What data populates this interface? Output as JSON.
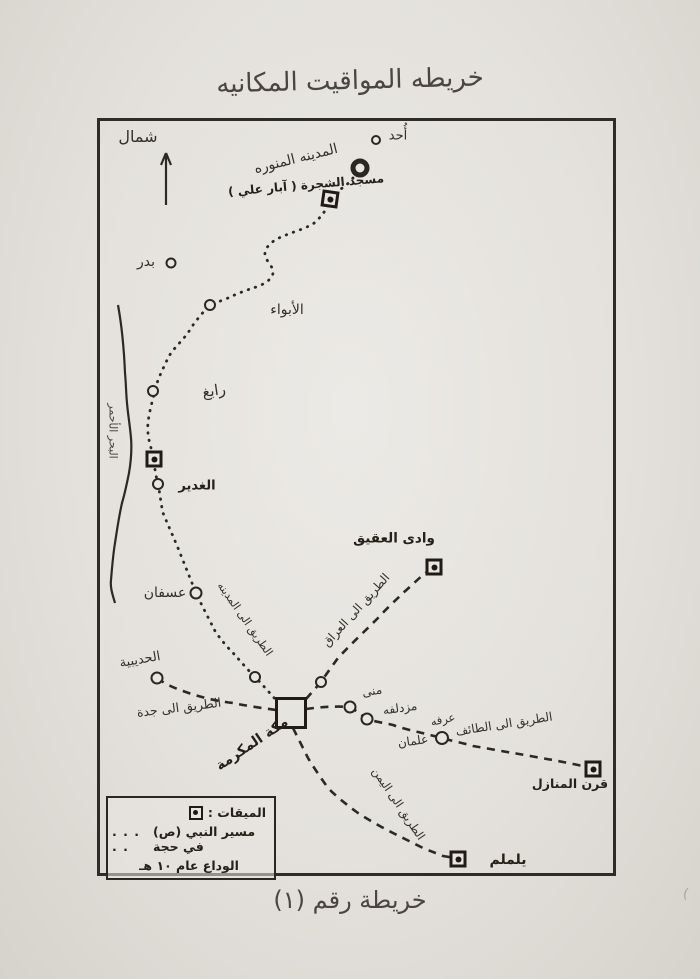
{
  "title": "خريطه المواقيت المكانيه",
  "caption": "خريطة رقم (١)",
  "margin_mark": "(",
  "compass": {
    "north": "شمال"
  },
  "places": {
    "uhud": "أُحد",
    "madinah": "المدينه المنوره",
    "masjid_shajarah": "مسجد الشجرة ( آبار علي )",
    "badr": "بدر",
    "abwa": "الأبواء",
    "rabigh": "رابغ",
    "ghadir": "الغدير",
    "red_sea": "البحر الأحمر",
    "usfan": "عسفان",
    "wadi_aqiq": "وادى العقيق",
    "hudaybiyyah": "الحديبية",
    "makkah": "مكة المكرمة",
    "mina": "منى",
    "muzdalifah": "مزدلفه",
    "arafah": "عرفه",
    "alaman": "علمان",
    "qarn_manazil": "قرن المنازل",
    "yalamlam": "يلملم"
  },
  "roads": {
    "to_madinah": "الطريق الى المدينه",
    "to_iraq": "الطريق الى العراق",
    "to_jeddah": "الطريق الى جدة",
    "to_taif": "الطريق الى الطائف",
    "to_yemen": "الطريق الى اليمن"
  },
  "legend": {
    "miqat_label": ": الميقات",
    "dots": ". . . . .",
    "route_line1": "مسير النبي (ص) في حجة",
    "route_line2": "الوداع عام ١٠ هـ"
  },
  "colors": {
    "ink": "#2c2925",
    "paper": "#e4e1dc"
  }
}
